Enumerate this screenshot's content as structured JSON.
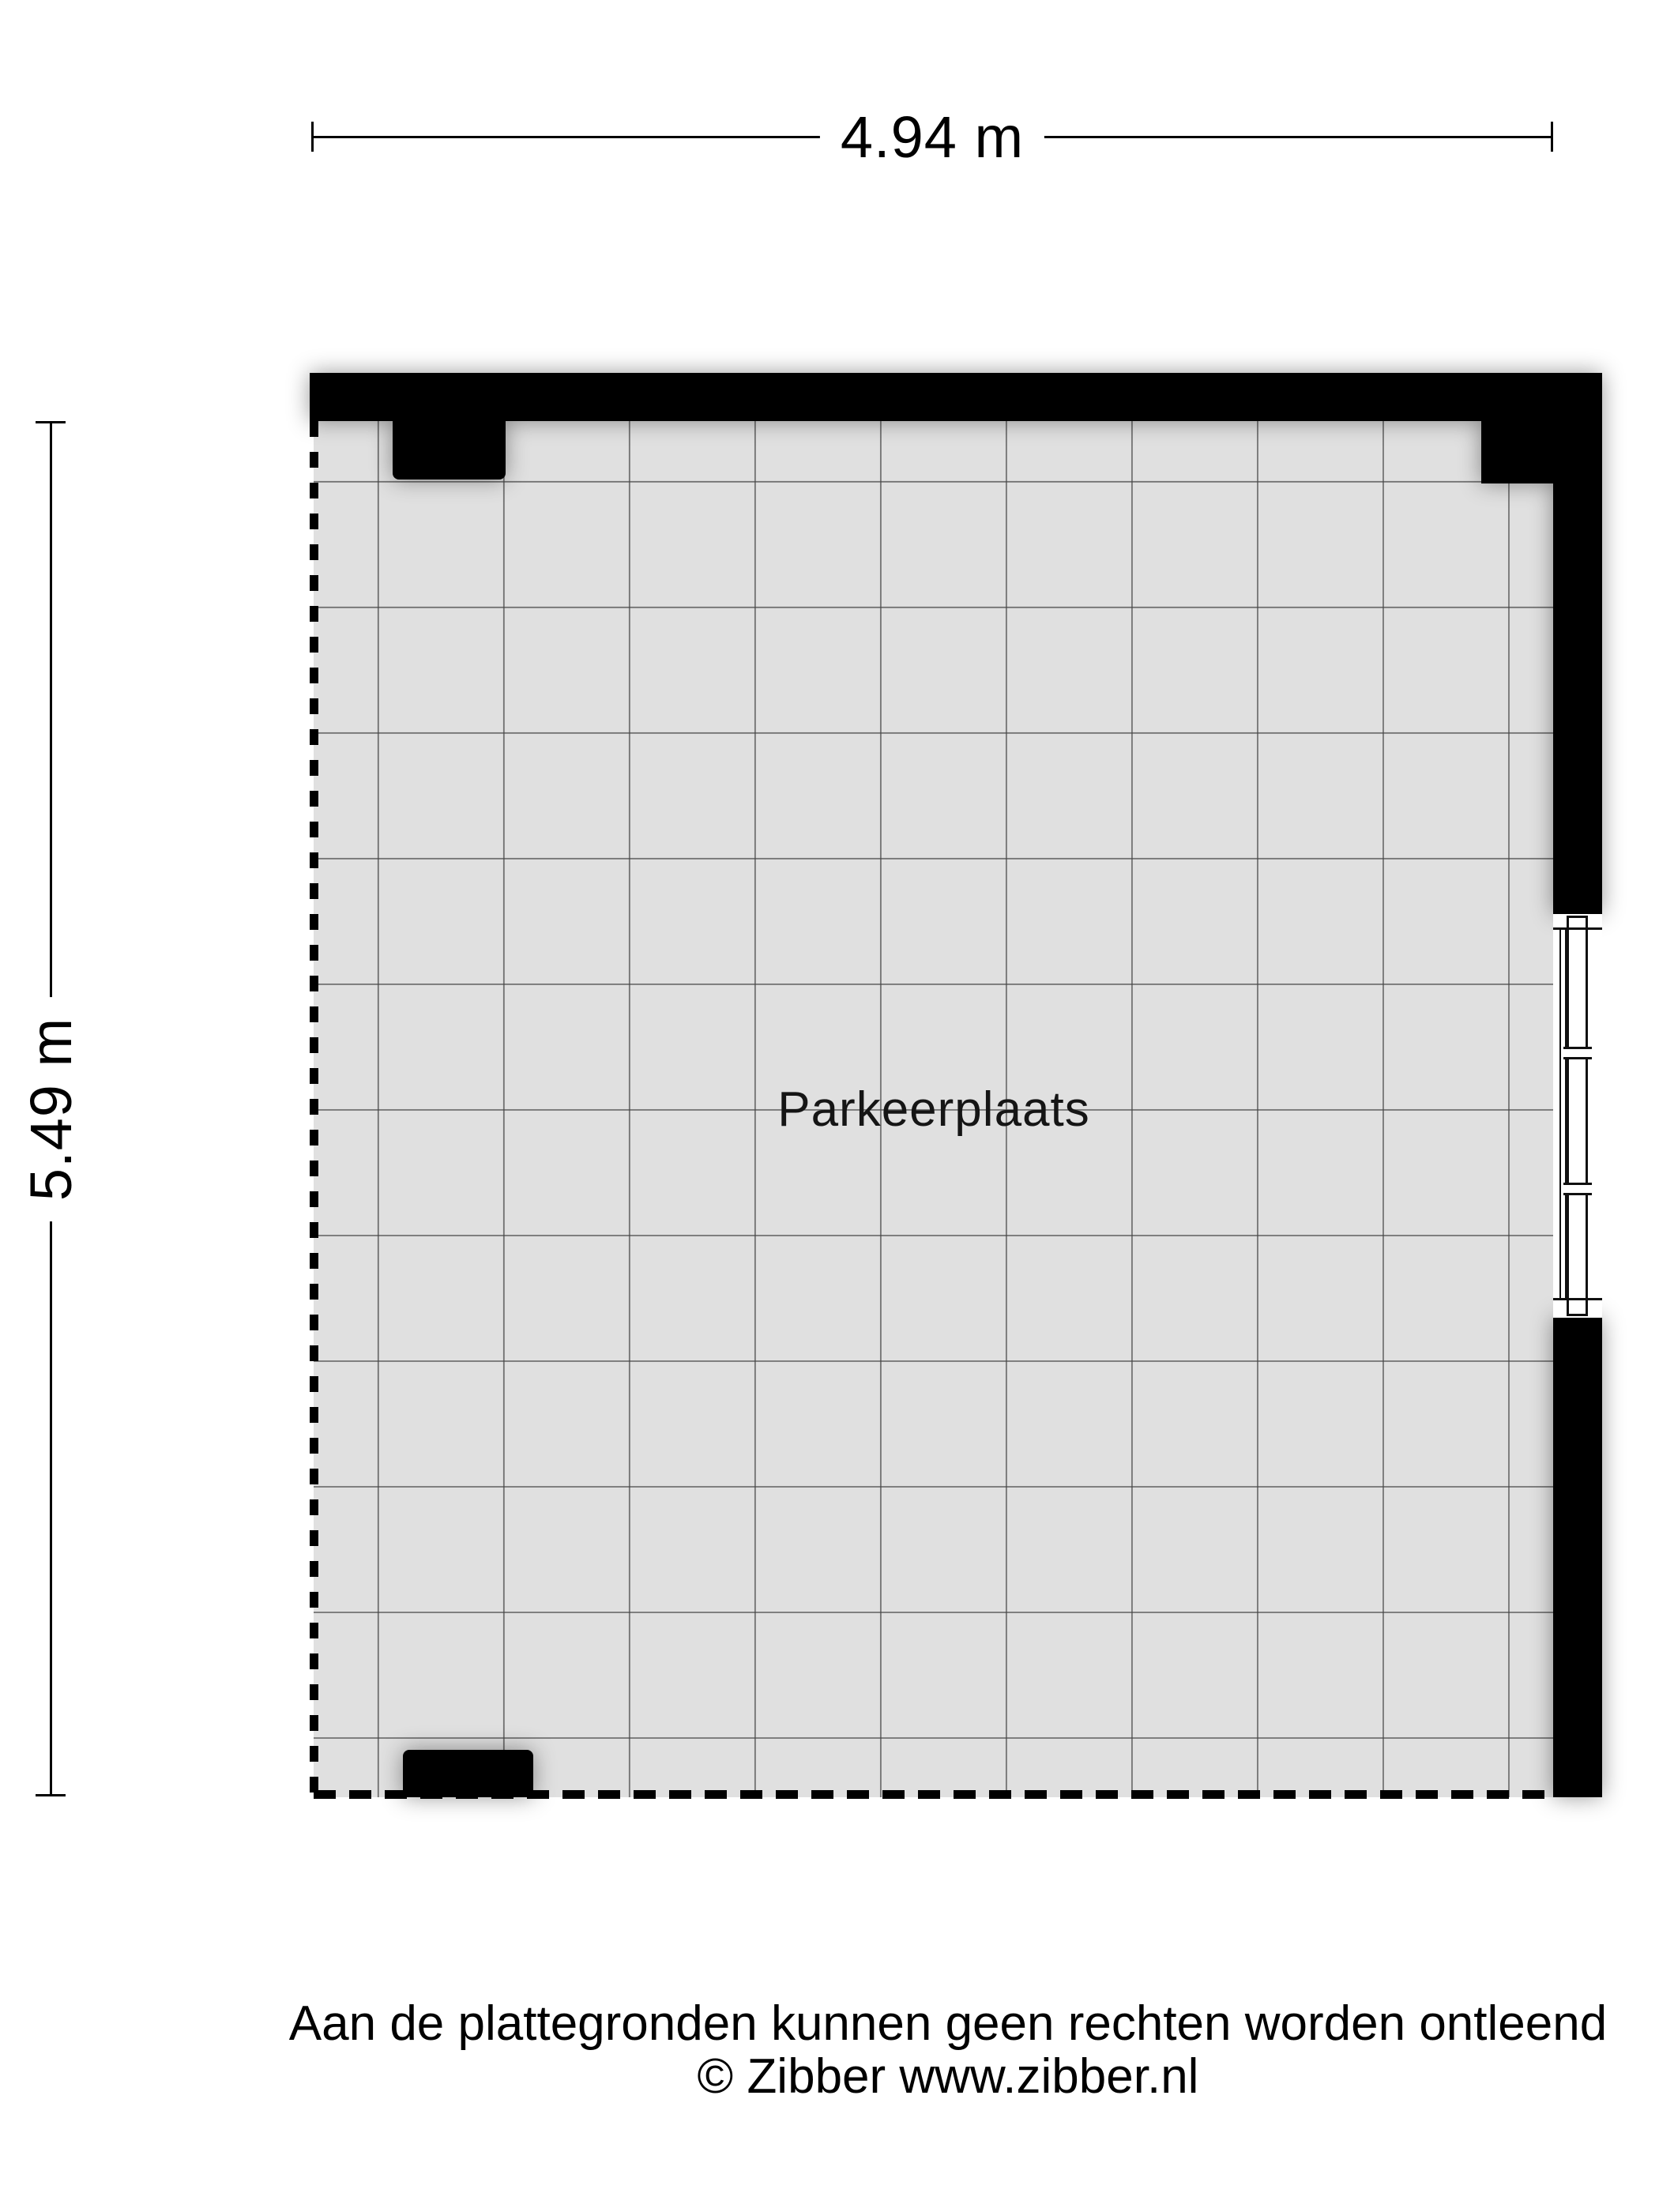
{
  "plan": {
    "room_label": "Parkeerplaats",
    "dim_width_label": "4.94 m",
    "dim_height_label": "5.49 m"
  },
  "footer": {
    "line1": "Aan de plattegronden kunnen geen rechten worden ontleend",
    "line2": "© Zibber www.zibber.nl"
  },
  "colors": {
    "wall": "#000000",
    "floor": "#e0e0e0",
    "grid": "#4f4f4f",
    "background": "#ffffff",
    "text": "#000000"
  }
}
